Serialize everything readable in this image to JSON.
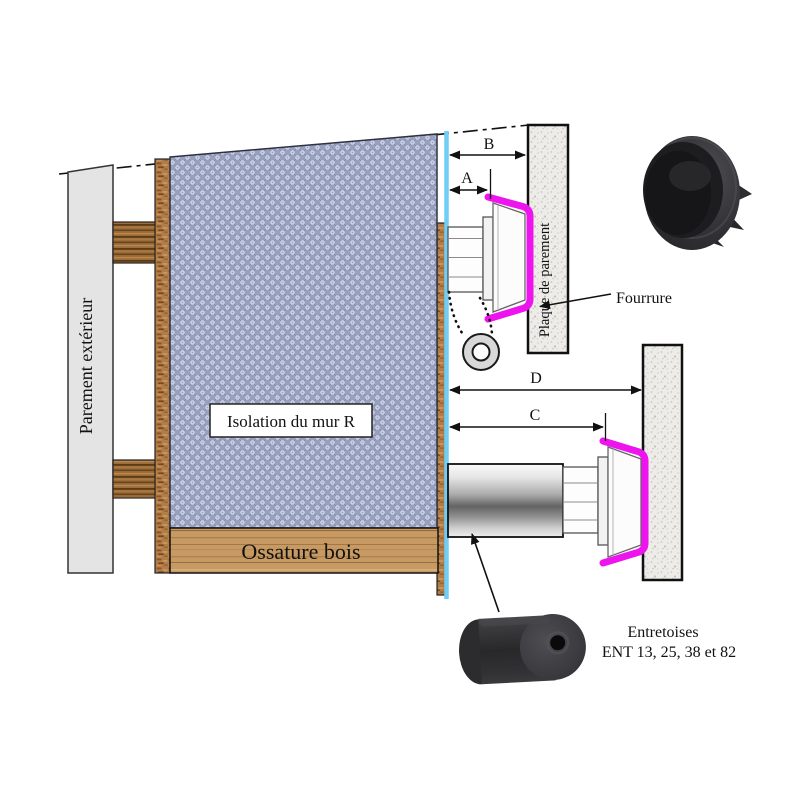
{
  "diagram": {
    "labels": {
      "parement_exterieur": "Parement extérieur",
      "isolation_mur": "Isolation du mur R",
      "ossature_bois": "Ossature bois",
      "plaque_parement": "Plaque de parement",
      "fourrure": "Fourrure",
      "entretoises_title": "Entretoises",
      "entretoises_ref": "ENT 13, 25, 38 et 82"
    },
    "dimension_labels": {
      "a": "A",
      "b": "B",
      "c": "C",
      "d": "D"
    },
    "colors": {
      "fourrure_highlight": "#ee14ee",
      "membrane_cyan": "#70cdf5",
      "insulation_base": "#8a92ae",
      "insulation_dots": "#ccd3f0",
      "wood_plank": "#c79a63",
      "wood_bar": "#9c6d3b",
      "panel_grey": "#e4e4e4",
      "plaque_speckle": "#edece9"
    }
  }
}
